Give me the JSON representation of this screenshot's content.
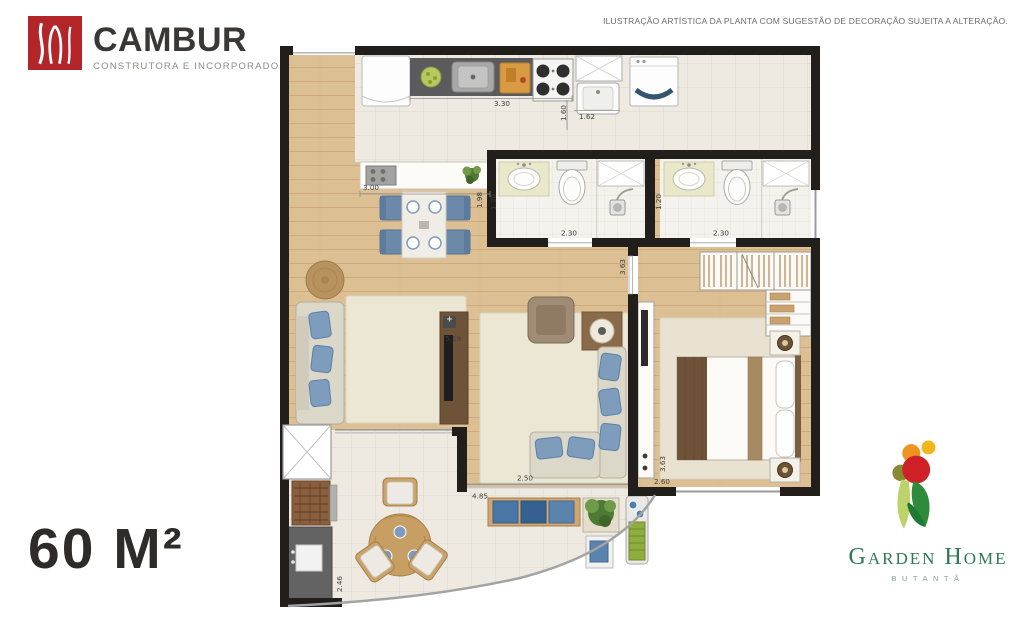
{
  "branding": {
    "developer": {
      "name": "CAMBUR",
      "tagline": "CONSTRUTORA E INCORPORADORA"
    },
    "project": {
      "name": "Garden Home",
      "location": "BUTANTÃ"
    }
  },
  "disclaimer": "ILUSTRAÇÃO ARTÍSTICA DA PLANTA COM SUGESTÃO DE DECORAÇÃO SUJEITA A ALTERAÇÃO.",
  "area_label": "60 M²",
  "floorplan": {
    "unit": "meters",
    "dimensions": [
      {
        "id": "kitchen-counter-length",
        "value": "3.30"
      },
      {
        "id": "service-width",
        "value": "1.60"
      },
      {
        "id": "service-length",
        "value": "1.62"
      },
      {
        "id": "island-length",
        "value": "3.00"
      },
      {
        "id": "kitchen-depth",
        "value": "1.98"
      },
      {
        "id": "bathroom1-width",
        "value": "1.20"
      },
      {
        "id": "bathroom1-length",
        "value": "2.30"
      },
      {
        "id": "bathroom2-width",
        "value": "1.20"
      },
      {
        "id": "bathroom2-length",
        "value": "2.30"
      },
      {
        "id": "hall-depth",
        "value": "3.63"
      },
      {
        "id": "living-length",
        "value": "5.19"
      },
      {
        "id": "living-width",
        "value": "2.50"
      },
      {
        "id": "terrace-length",
        "value": "4.85"
      },
      {
        "id": "bedroom-depth",
        "value": "3.63"
      },
      {
        "id": "bedroom-width",
        "value": "2.60"
      },
      {
        "id": "terrace-depth",
        "value": "2.46"
      }
    ]
  },
  "colors": {
    "brand_red": "#b4252a",
    "project_green": "#2e7a52",
    "wall": "#221e1b",
    "wood_floor": "#dcc094",
    "tile_floor": "#eeeae1",
    "rug": "#ece6d5",
    "sofa_beige": "#dbd7c9",
    "pillow_blue": "#7e9dbd",
    "counter_dark": "#5b5b5d"
  }
}
